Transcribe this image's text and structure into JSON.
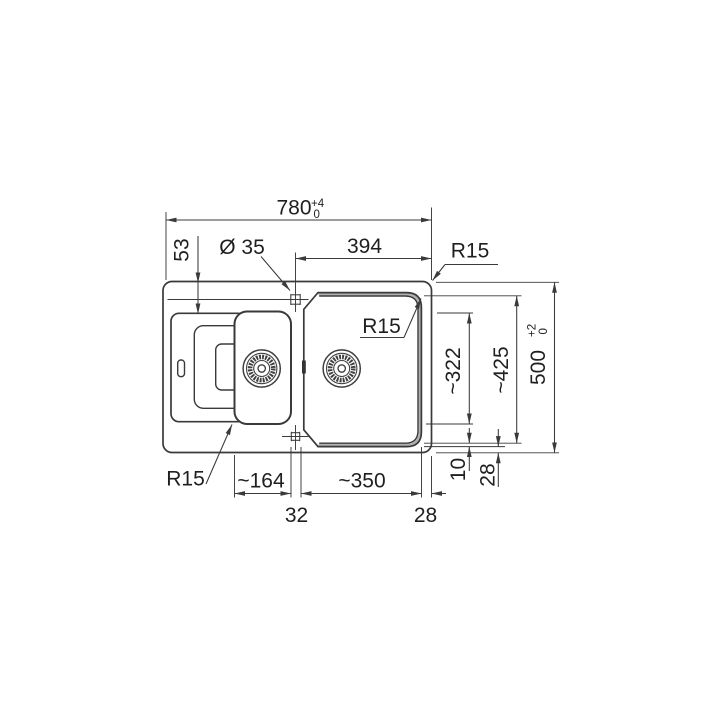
{
  "drawing": {
    "type": "technical-dimension-drawing",
    "subject": "kitchen sink with drainboard, half bowl and main bowl (top view)",
    "colors": {
      "background": "#ffffff",
      "line": "#3a3a3a",
      "text": "#1f1f1f",
      "rim_band": "#b0b0b0"
    },
    "labels": {
      "overall_width": {
        "text": "780",
        "tol_top": "+4",
        "tol_bottom": "0"
      },
      "overall_depth": {
        "text": "500",
        "tol_top": "+2",
        "tol_bottom": "0"
      },
      "tap_hole_dia": "Ø 35",
      "tap_to_right_edge": "394",
      "tap_to_rear_edge": "53",
      "radius_outer": "R15",
      "radius_main_bowl": "R15",
      "radius_half_bowl": "R15",
      "half_bowl_width": "~164",
      "main_bowl_width": "~350",
      "center_web": "32",
      "edge_to_bowl_right": "28",
      "half_bowl_length": "~322",
      "main_bowl_length": "~425",
      "rim_gap": "10",
      "bowl_to_front_edge": "28"
    }
  }
}
